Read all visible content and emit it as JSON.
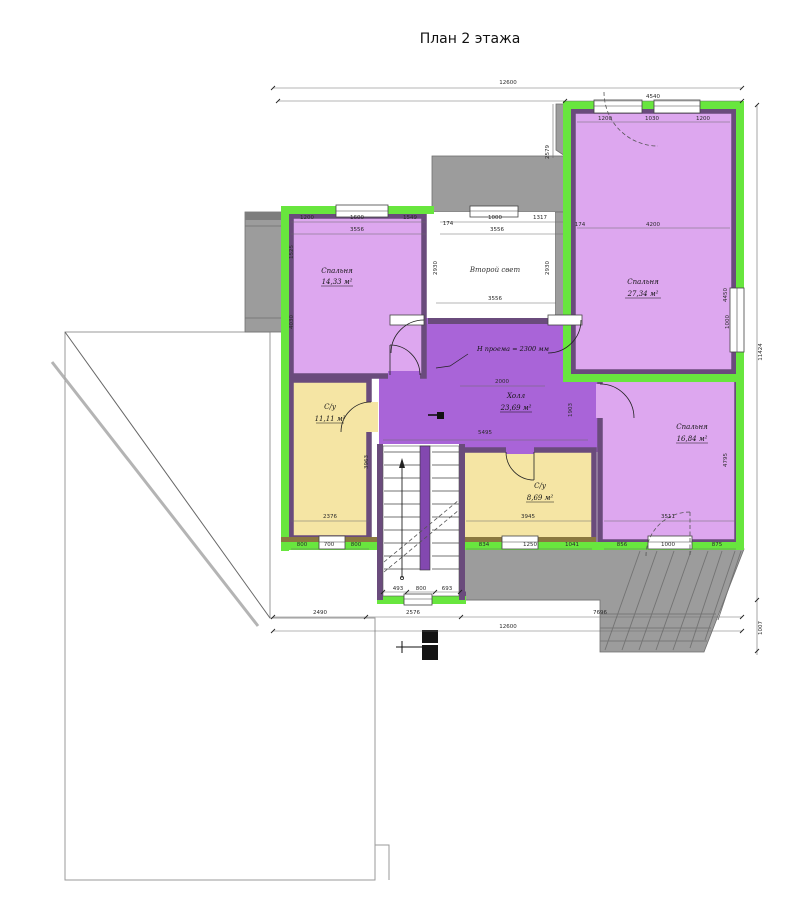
{
  "title": "План 2 этажа",
  "rooms": {
    "bedroom_top_left": {
      "name": "Спальня",
      "area": "14,33 м²"
    },
    "bedroom_top_right": {
      "name": "Спальня",
      "area": "27,34 м²"
    },
    "bedroom_bottom_right": {
      "name": "Спальня",
      "area": "16,84 м²"
    },
    "hall": {
      "name": "Холл",
      "area": "23,69 м²"
    },
    "bathroom_left": {
      "name": "С/у",
      "area": "11,11 м²"
    },
    "bathroom_right": {
      "name": "С/у",
      "area": "8,69 м²"
    },
    "second_light": {
      "name": "Второй свет"
    }
  },
  "annotations": {
    "opening_height": "Н проема = 2300 мм"
  },
  "colors": {
    "wall_green": "#68e63e",
    "wall_core": "#6a4b7c",
    "room_violet": "#dda7ef",
    "hall_purple": "#a964d8",
    "wc_yellow": "#f5e5a4",
    "wc_wall": "#8a7840",
    "roof_gray": "#9c9c9c",
    "roof_dark": "#6f6f6f",
    "stair_wall": "#8348b0"
  },
  "dimensions": [
    {
      "x": 508,
      "y": 84,
      "t": "12600"
    },
    {
      "x": 653,
      "y": 98,
      "t": "4540"
    },
    {
      "x": 762,
      "y": 352,
      "t": "11424",
      "r": 1
    },
    {
      "x": 762,
      "y": 628,
      "t": "1007",
      "r": 1
    },
    {
      "x": 549,
      "y": 152,
      "t": "2579",
      "r": 1
    },
    {
      "x": 320,
      "y": 614,
      "t": "2490"
    },
    {
      "x": 413,
      "y": 614,
      "t": "2576"
    },
    {
      "x": 600,
      "y": 614,
      "t": "7696"
    },
    {
      "x": 508,
      "y": 628,
      "t": "12600"
    },
    {
      "x": 307,
      "y": 219,
      "t": "1200"
    },
    {
      "x": 357,
      "y": 219,
      "t": "1600"
    },
    {
      "x": 410,
      "y": 219,
      "t": "1549"
    },
    {
      "x": 357,
      "y": 231,
      "t": "3556"
    },
    {
      "x": 448,
      "y": 225,
      "t": "174"
    },
    {
      "x": 495,
      "y": 219,
      "t": "1000"
    },
    {
      "x": 540,
      "y": 219,
      "t": "1317"
    },
    {
      "x": 497,
      "y": 231,
      "t": "3556"
    },
    {
      "x": 495,
      "y": 300,
      "t": "3556"
    },
    {
      "x": 605,
      "y": 120,
      "t": "1200"
    },
    {
      "x": 652,
      "y": 120,
      "t": "1030"
    },
    {
      "x": 703,
      "y": 120,
      "t": "1200"
    },
    {
      "x": 580,
      "y": 226,
      "t": "174"
    },
    {
      "x": 653,
      "y": 226,
      "t": "4200"
    },
    {
      "x": 727,
      "y": 295,
      "t": "4450",
      "r": 1
    },
    {
      "x": 293,
      "y": 252,
      "t": "1525",
      "r": 1
    },
    {
      "x": 293,
      "y": 322,
      "t": "4030",
      "r": 1
    },
    {
      "x": 437,
      "y": 268,
      "t": "2930",
      "r": 1
    },
    {
      "x": 549,
      "y": 268,
      "t": "2930",
      "r": 1
    },
    {
      "x": 330,
      "y": 518,
      "t": "2376"
    },
    {
      "x": 302,
      "y": 546,
      "t": "800"
    },
    {
      "x": 329,
      "y": 546,
      "t": "700"
    },
    {
      "x": 356,
      "y": 546,
      "t": "800"
    },
    {
      "x": 528,
      "y": 518,
      "t": "3945"
    },
    {
      "x": 484,
      "y": 546,
      "t": "834"
    },
    {
      "x": 530,
      "y": 546,
      "t": "1250"
    },
    {
      "x": 572,
      "y": 546,
      "t": "1041"
    },
    {
      "x": 668,
      "y": 518,
      "t": "3511"
    },
    {
      "x": 622,
      "y": 546,
      "t": "856"
    },
    {
      "x": 668,
      "y": 546,
      "t": "1000"
    },
    {
      "x": 717,
      "y": 546,
      "t": "875"
    },
    {
      "x": 485,
      "y": 434,
      "t": "5495"
    },
    {
      "x": 398,
      "y": 590,
      "t": "493"
    },
    {
      "x": 421,
      "y": 590,
      "t": "800"
    },
    {
      "x": 447,
      "y": 590,
      "t": "693"
    },
    {
      "x": 368,
      "y": 462,
      "t": "3963",
      "r": 1
    },
    {
      "x": 727,
      "y": 460,
      "t": "4795",
      "r": 1
    },
    {
      "x": 729,
      "y": 322,
      "t": "1000",
      "r": 1
    },
    {
      "x": 572,
      "y": 410,
      "t": "1903",
      "r": 1
    },
    {
      "x": 502,
      "y": 383,
      "t": "2000"
    }
  ]
}
